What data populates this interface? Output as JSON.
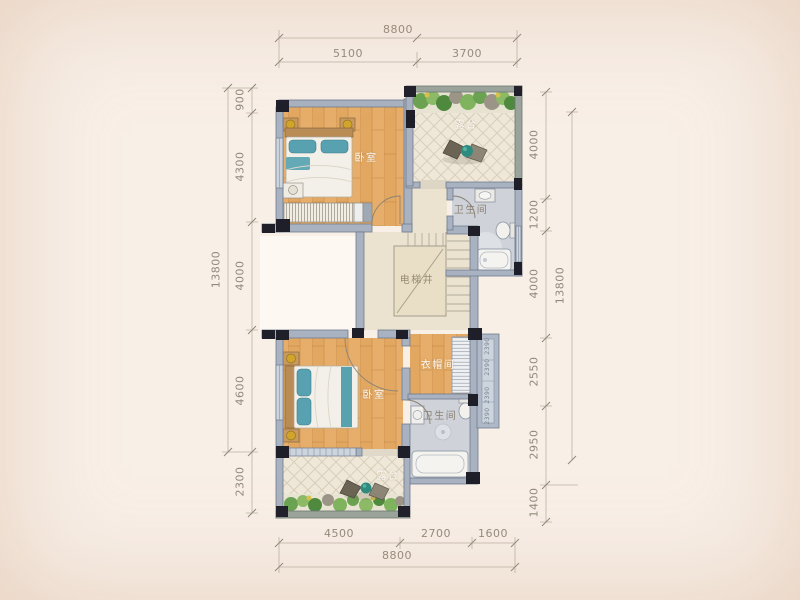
{
  "meta": {
    "type": "residential-floor-plan"
  },
  "colors": {
    "background": "#f8efe7",
    "wood_floor": "#e2a862",
    "terrace_tile": "#efe8d9",
    "bath_floor": "#cfd3d9",
    "wall_dark": "#1f1f2a",
    "wall_light": "#a9b2c0",
    "plant_green": "#6aa351",
    "accent_teal": "#57a1b0"
  },
  "rooms": {
    "bedroom_top": {
      "label": "卧室"
    },
    "terrace_top": {
      "label": "露台"
    },
    "bathroom_top": {
      "label": "卫生间"
    },
    "elevator_shaft": {
      "label": "电梯井"
    },
    "bedroom_bottom": {
      "label": "卧室"
    },
    "cloakroom": {
      "label": "衣帽间"
    },
    "bathroom_bottom": {
      "label": "卫生间"
    },
    "terrace_bottom": {
      "label": "露台"
    }
  },
  "dimensions": {
    "top": {
      "total": "8800",
      "segments": [
        "5100",
        "3700"
      ]
    },
    "bottom": {
      "total": "8800",
      "segments": [
        "4500",
        "2700",
        "1600"
      ]
    },
    "left": {
      "total": "13800",
      "segments": [
        "900",
        "4300",
        "4000",
        "4600",
        "2300"
      ]
    },
    "right": {
      "total": "13800",
      "segments": [
        "4000",
        "1200",
        "4000",
        "2550",
        "2950",
        "1400"
      ]
    },
    "bay_window": {
      "labels": [
        "2390",
        "2390",
        "2390",
        "2390"
      ]
    }
  }
}
